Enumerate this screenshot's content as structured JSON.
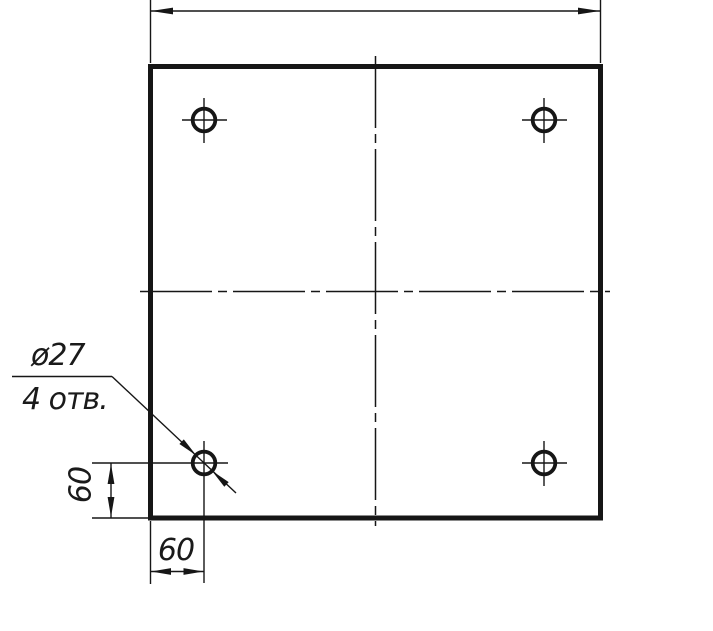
{
  "drawing": {
    "background_color": "#ffffff",
    "ink_color": "#161616",
    "leader_note": {
      "diameter_label": "ø27",
      "holes_label": "4 отв."
    },
    "dimensions": {
      "hole_offset_vertical": "60",
      "hole_offset_horizontal": "60"
    }
  }
}
